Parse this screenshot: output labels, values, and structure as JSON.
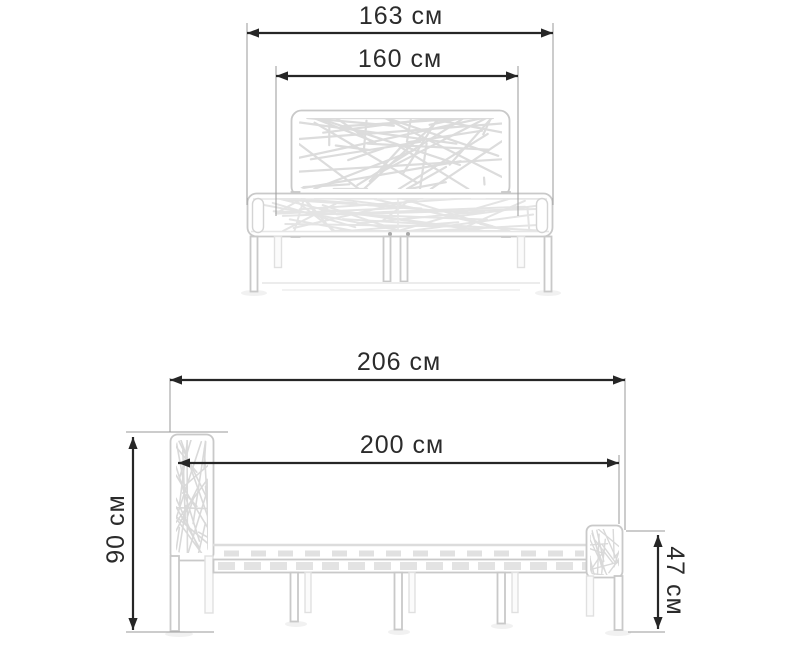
{
  "page": {
    "background": "#ffffff",
    "description_label": "bed dimensions diagram"
  },
  "units": "см",
  "colors": {
    "dimension_line": "#262626",
    "dimension_text": "#2b2b2b",
    "extension_line": "#9a9a9a",
    "bed_outline": "#c9c9c9",
    "bed_pattern": "#dcdcdc"
  },
  "views": {
    "front": {
      "name": "front-view",
      "dimensions": {
        "overall_width": {
          "label": "163 см",
          "value": 163,
          "unit": "см"
        },
        "sleeping_width": {
          "label": "160 см",
          "value": 160,
          "unit": "см"
        }
      }
    },
    "side": {
      "name": "side-view",
      "dimensions": {
        "overall_length": {
          "label": "206 см",
          "value": 206,
          "unit": "см"
        },
        "sleeping_length": {
          "label": "200 см",
          "value": 200,
          "unit": "см"
        },
        "headboard_height": {
          "label": "90 см",
          "value": 90,
          "unit": "см"
        },
        "footboard_height": {
          "label": "47 см",
          "value": 47,
          "unit": "см"
        }
      }
    }
  }
}
